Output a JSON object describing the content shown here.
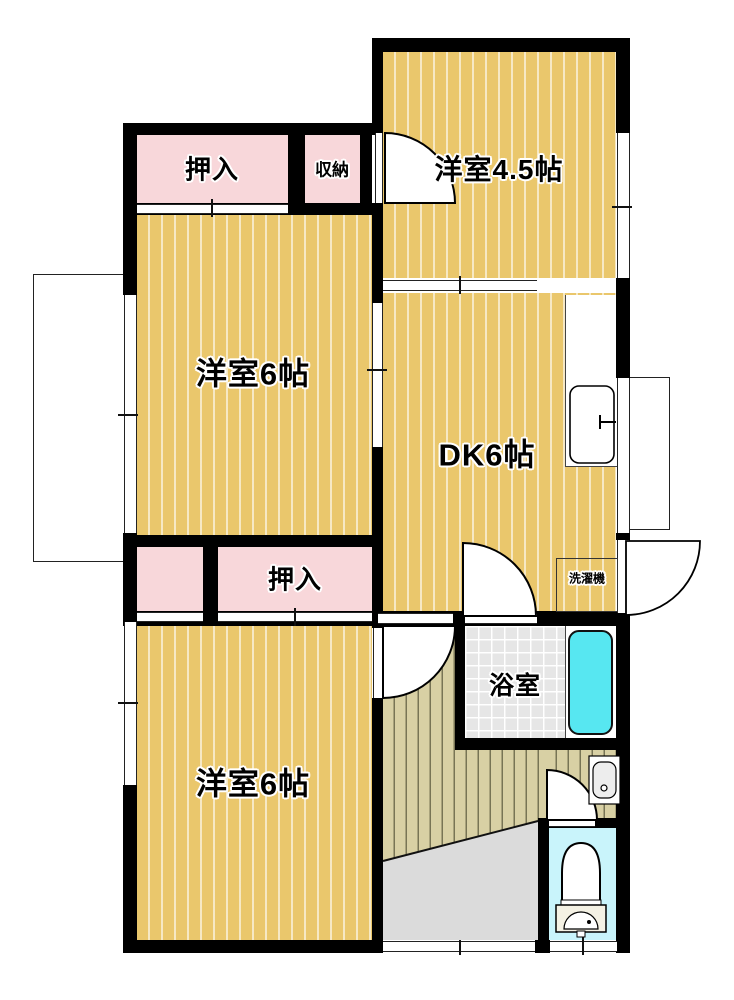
{
  "floorplan": {
    "labels": {
      "room45": "洋室4.5帖",
      "room6_mid": "洋室6帖",
      "dk": "DK6帖",
      "room6_bot": "洋室6帖",
      "oshiire_top": "押入",
      "shuno": "収納",
      "oshiire_bottom": "押入",
      "bath": "浴室",
      "laundry": "洗濯機"
    },
    "colors": {
      "floor_yellow": "#EAC76C",
      "closet_pink": "#F8D7DA",
      "corridor_khaki": "#D8D0A4",
      "genkan_gray": "#DBDBDB",
      "tile_gray": "#E6E6E6",
      "bathtub_cyan": "#57E7F1",
      "toilet_floor_cyan": "#C9F4FB",
      "wall_black": "#000000"
    }
  }
}
